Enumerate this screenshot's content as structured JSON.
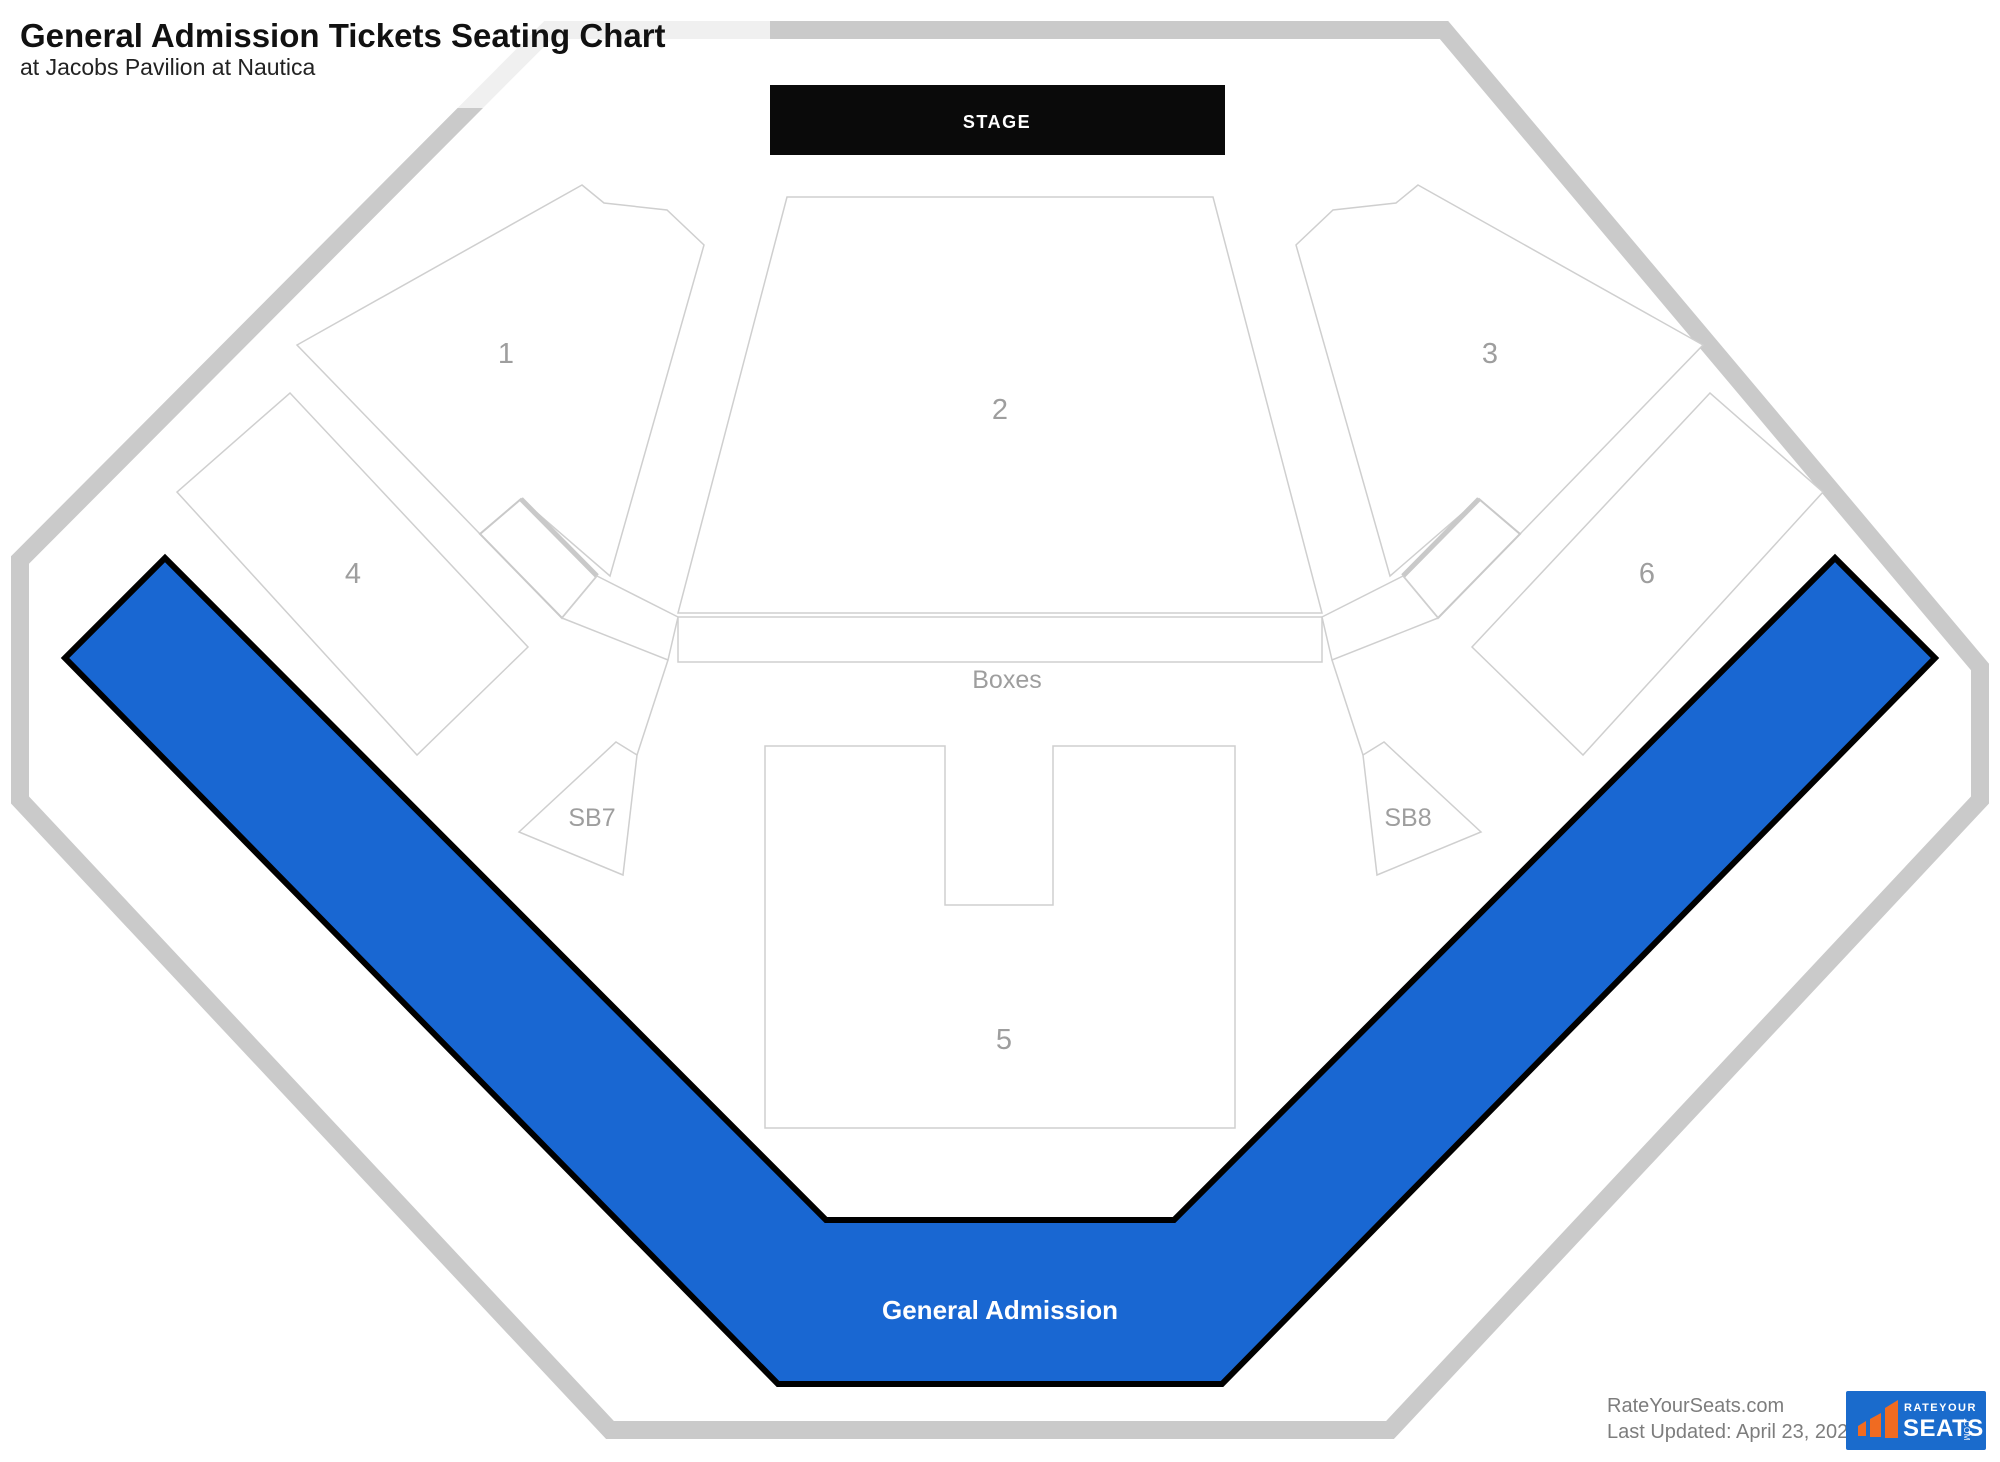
{
  "header": {
    "title": "General Admission Tickets Seating Chart",
    "subtitle": "at Jacobs Pavilion at Nautica"
  },
  "stage": {
    "label": "STAGE"
  },
  "sections": {
    "s1": {
      "label": "1"
    },
    "s2": {
      "label": "2"
    },
    "s3": {
      "label": "3"
    },
    "s4": {
      "label": "4"
    },
    "s5": {
      "label": "5"
    },
    "s6": {
      "label": "6"
    },
    "boxes": {
      "label": "Boxes"
    },
    "sb7": {
      "label": "SB7"
    },
    "sb8": {
      "label": "SB8"
    },
    "general_admission": {
      "label": "General Admission"
    }
  },
  "footer": {
    "site": "RateYourSeats.com",
    "updated": "Last Updated: April 23, 2022"
  },
  "logo": {
    "top": "RATEYOUR",
    "main": "SEATS",
    "suffix": ".COM"
  },
  "colors": {
    "ga_fill": "#1967d2",
    "ga_stroke": "#000000",
    "outline": "#cfcfcf",
    "outline_thick": "#c9c9c9",
    "octagon": "#cacaca",
    "label": "#9e9e9e",
    "stage_bg": "#0a0a0a",
    "stage_text": "#ffffff",
    "logo_bg": "#1a6bcc",
    "logo_orange": "#f06b21",
    "footer_text": "#7d7d7d"
  }
}
